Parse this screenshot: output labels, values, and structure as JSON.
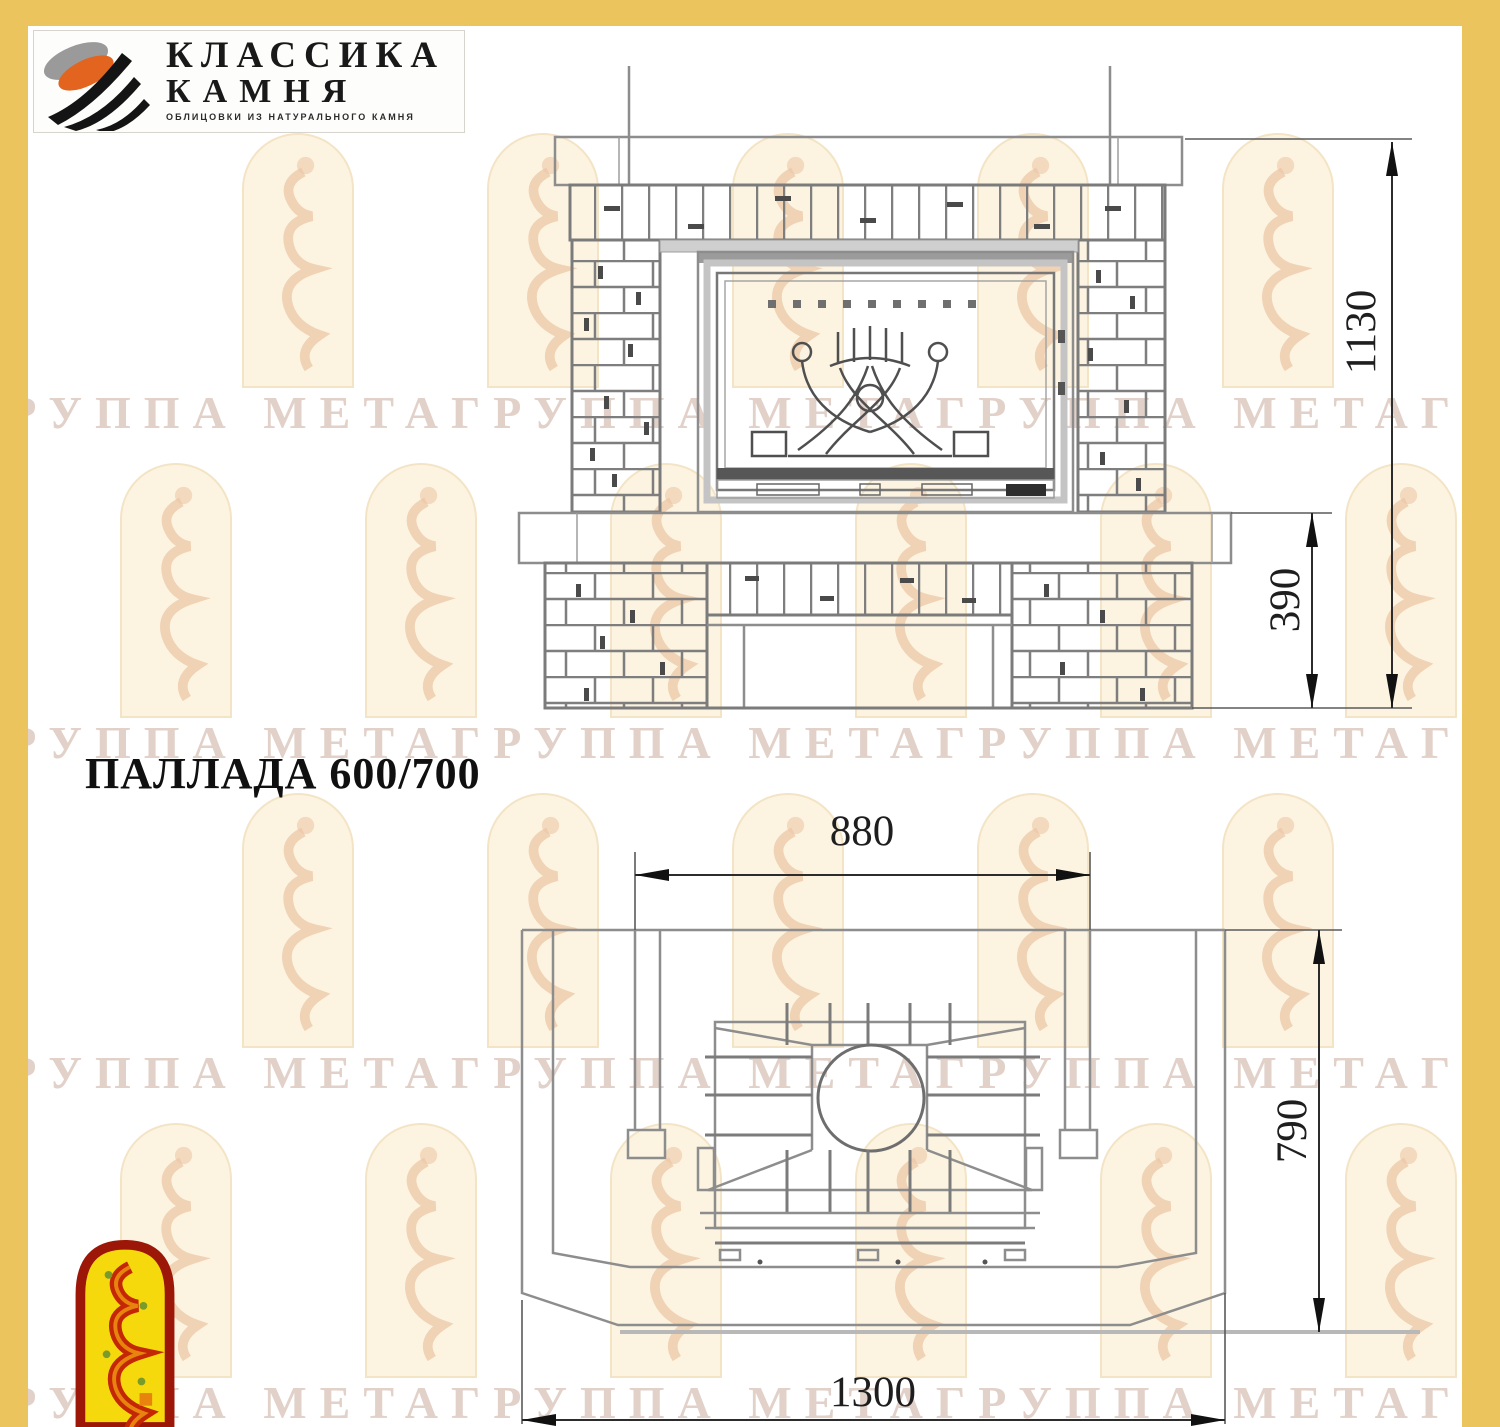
{
  "brand": {
    "name_line1": "КЛАССИКА",
    "name_line2": "КАМНЯ",
    "tagline": "ОБЛИЦОВКИ ИЗ НАТУРАЛЬНОГО КАМНЯ"
  },
  "title": "ПАЛЛАДА 600/700",
  "watermark": {
    "row_text": "ГРУППА МЕТАГРУППА МЕТАГРУППА МЕТАГРУППА МЕТА"
  },
  "front_view": {
    "dim_total_height": "1130",
    "dim_base_height": "390"
  },
  "plan_view": {
    "dim_opening_width": "880",
    "dim_depth": "790",
    "dim_total_width": "1300"
  },
  "colors": {
    "frame_yellow": "#ecc45e",
    "drawing_line": "#8d8d8d",
    "dimension_text": "#1e1e1e",
    "logo_orange": "#e2641e",
    "corner_logo_red": "#c32705",
    "corner_logo_yellow": "#f6d90d"
  }
}
